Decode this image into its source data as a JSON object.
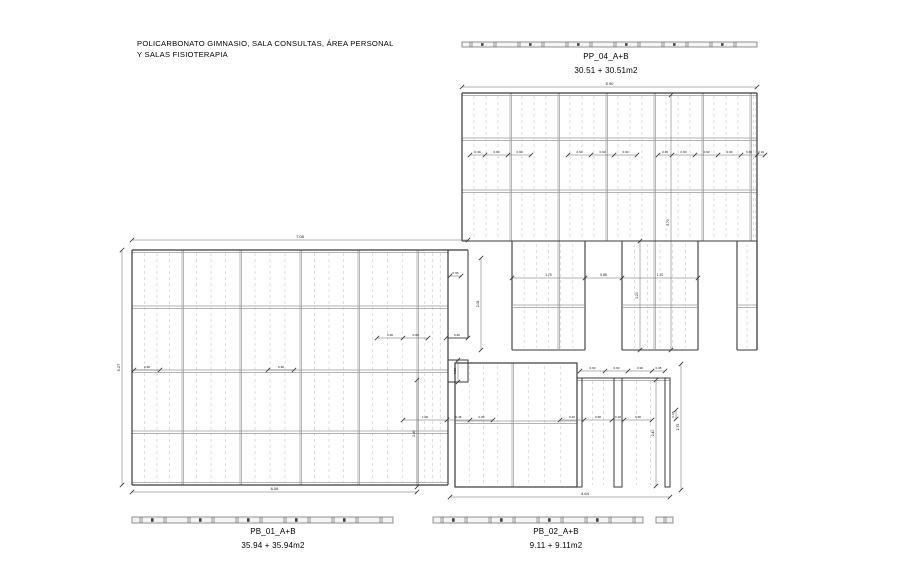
{
  "title": {
    "line1": "POLICARBONATO GIMNASIO, SALA CONSULTAS, ÁREA PERSONAL",
    "line2": "Y SALAS FISIOTERAPIA"
  },
  "plans": {
    "pp04": {
      "name": "PP_04_A+B",
      "area": "30.51 + 30.51m2"
    },
    "pb01": {
      "name": "PB_01_A+B",
      "area": "35.94 + 35.94m2"
    },
    "pb02": {
      "name": "PB_02_A+B",
      "area": "9.11 + 9.11m2"
    }
  },
  "colors": {
    "outline": "#3a3a3a",
    "joint": "#9a9a9a",
    "dashed": "#c9c9c9",
    "dim_line": "#666666",
    "dim_tick": "#333333",
    "dim_text": "#111111",
    "bar_fill": "#f4f4f4",
    "bar_stroke": "#777777",
    "bar_mark": "#444444"
  },
  "drawing": {
    "pp04": {
      "x": 462,
      "right": 757,
      "top": 93,
      "band_bottom": 241,
      "bottom": 350,
      "joints": [
        510,
        558,
        606,
        654,
        702,
        750
      ],
      "rails": [
        138,
        190
      ],
      "legs": [
        [
          512,
          585
        ],
        [
          622,
          698
        ],
        [
          737,
          757
        ]
      ],
      "leg_joints": [
        558,
        654
      ],
      "leg_rail": 305
    },
    "pb01": {
      "x": 132,
      "right": 448,
      "top": 250,
      "bottom": 485,
      "joints": [
        182,
        240,
        300,
        358,
        417
      ],
      "rails": [
        306,
        370,
        431
      ],
      "appendage": {
        "x": 448,
        "right": 468,
        "top": 250,
        "bottom": 338
      },
      "small_rect": {
        "x": 448,
        "right": 468,
        "top": 360,
        "bottom": 382
      }
    },
    "pb02": {
      "x": 455,
      "right": 577,
      "top": 363,
      "bottom": 487,
      "joints": [
        512
      ],
      "rails": [
        421
      ],
      "open_rail_y": 378,
      "open_right": 670,
      "columns": [
        [
          577,
          582
        ],
        [
          614,
          622
        ],
        [
          665,
          670
        ]
      ]
    },
    "bars": [
      {
        "y": 42,
        "h": 5,
        "segments": [
          [
            462,
            757
          ]
        ]
      },
      {
        "y": 517,
        "h": 6,
        "segments": [
          [
            132,
            393
          ],
          [
            433,
            643
          ],
          [
            656,
            673
          ]
        ]
      }
    ],
    "dims": [
      {
        "o": "h",
        "y": 87,
        "ticks": [
          462,
          757
        ],
        "labels": [
          "5.90"
        ],
        "fs": 4
      },
      {
        "o": "h",
        "y": 155,
        "ticks": [
          470,
          485,
          508,
          531
        ],
        "labels": [
          "0.30",
          "0.90",
          "0.90"
        ],
        "fs": 3.1
      },
      {
        "o": "h",
        "y": 155,
        "ticks": [
          568,
          591,
          614,
          637
        ],
        "labels": [
          "0.90",
          "0.90",
          "0.90"
        ],
        "fs": 3.1
      },
      {
        "o": "h",
        "y": 155,
        "ticks": [
          658,
          672,
          695,
          718,
          741,
          757,
          765
        ],
        "labels": [
          "0.30",
          "0.90",
          "0.90",
          "0.90",
          "0.30",
          "0.16"
        ],
        "fs": 3.1
      },
      {
        "o": "h",
        "y": 278,
        "ticks": [
          512,
          585,
          622,
          698
        ],
        "labels": [
          "1.70",
          "0.88",
          "1.70"
        ],
        "fs": 3.4
      },
      {
        "o": "v",
        "x": 671,
        "ticks": [
          95,
          350
        ],
        "labels": [
          "5.70"
        ],
        "fs": 3.4
      },
      {
        "o": "v",
        "x": 640,
        "ticks": [
          241,
          350
        ],
        "labels": [
          "2.20"
        ],
        "fs": 3.4
      },
      {
        "o": "h",
        "y": 240,
        "ticks": [
          132,
          468
        ],
        "labels": [
          "7.08"
        ],
        "fs": 4
      },
      {
        "o": "v",
        "x": 122,
        "ticks": [
          250,
          485
        ],
        "labels": [
          "5.27"
        ],
        "fs": 4
      },
      {
        "o": "h",
        "y": 492,
        "ticks": [
          132,
          417
        ],
        "labels": [
          "6.06"
        ],
        "fs": 4
      },
      {
        "o": "h",
        "y": 370,
        "ticks": [
          134,
          160
        ],
        "labels": [
          "0.90"
        ],
        "fs": 3.1
      },
      {
        "o": "h",
        "y": 370,
        "ticks": [
          268,
          294
        ],
        "labels": [
          "0.90"
        ],
        "fs": 3.1
      },
      {
        "o": "h",
        "y": 338,
        "ticks": [
          377,
          403,
          428
        ],
        "labels": [
          "0.90",
          "0.90"
        ],
        "fs": 3.1
      },
      {
        "o": "h",
        "y": 338,
        "ticks": [
          446,
          468
        ],
        "labels": [
          "0.46"
        ],
        "fs": 3.1
      },
      {
        "o": "h",
        "y": 276,
        "ticks": [
          450,
          461
        ],
        "labels": [
          "0.06"
        ],
        "fs": 3.1
      },
      {
        "o": "v",
        "x": 481,
        "ticks": [
          258,
          350
        ],
        "labels": [
          "2.08"
        ],
        "fs": 3.4
      },
      {
        "o": "v",
        "x": 458,
        "ticks": [
          360,
          382
        ],
        "labels": [
          "0.85"
        ],
        "fs": 3.1
      },
      {
        "o": "v",
        "x": 417,
        "ticks": [
          380,
          487
        ],
        "labels": [
          "2.40"
        ],
        "fs": 3.4
      },
      {
        "o": "h",
        "y": 420,
        "ticks": [
          403,
          447,
          470,
          493
        ],
        "labels": [
          "1.06",
          "0.46",
          "0.90"
        ],
        "fs": 3.1
      },
      {
        "o": "h",
        "y": 420,
        "ticks": [
          560,
          584,
          612,
          624,
          652
        ],
        "labels": [
          "0.40",
          "0.90",
          "0.20",
          "0.90"
        ],
        "fs": 3.1
      },
      {
        "o": "h",
        "y": 371,
        "ticks": [
          580,
          605,
          628,
          652,
          665
        ],
        "labels": [
          "0.90",
          "0.90",
          "0.90",
          "0.45"
        ],
        "fs": 3.1
      },
      {
        "o": "v",
        "x": 656,
        "ticks": [
          380,
          486
        ],
        "labels": [
          "2.40"
        ],
        "fs": 3.4
      },
      {
        "o": "v",
        "x": 676,
        "ticks": [
          410,
          419
        ],
        "labels": [
          "0.08"
        ],
        "fs": 3.1
      },
      {
        "o": "v",
        "x": 681,
        "ticks": [
          364,
          490
        ],
        "labels": [
          "2.75"
        ],
        "fs": 3.4
      },
      {
        "o": "h",
        "y": 497,
        "ticks": [
          450,
          670
        ],
        "labels": [
          "4.64"
        ],
        "fs": 4,
        "lx": 585
      }
    ]
  }
}
